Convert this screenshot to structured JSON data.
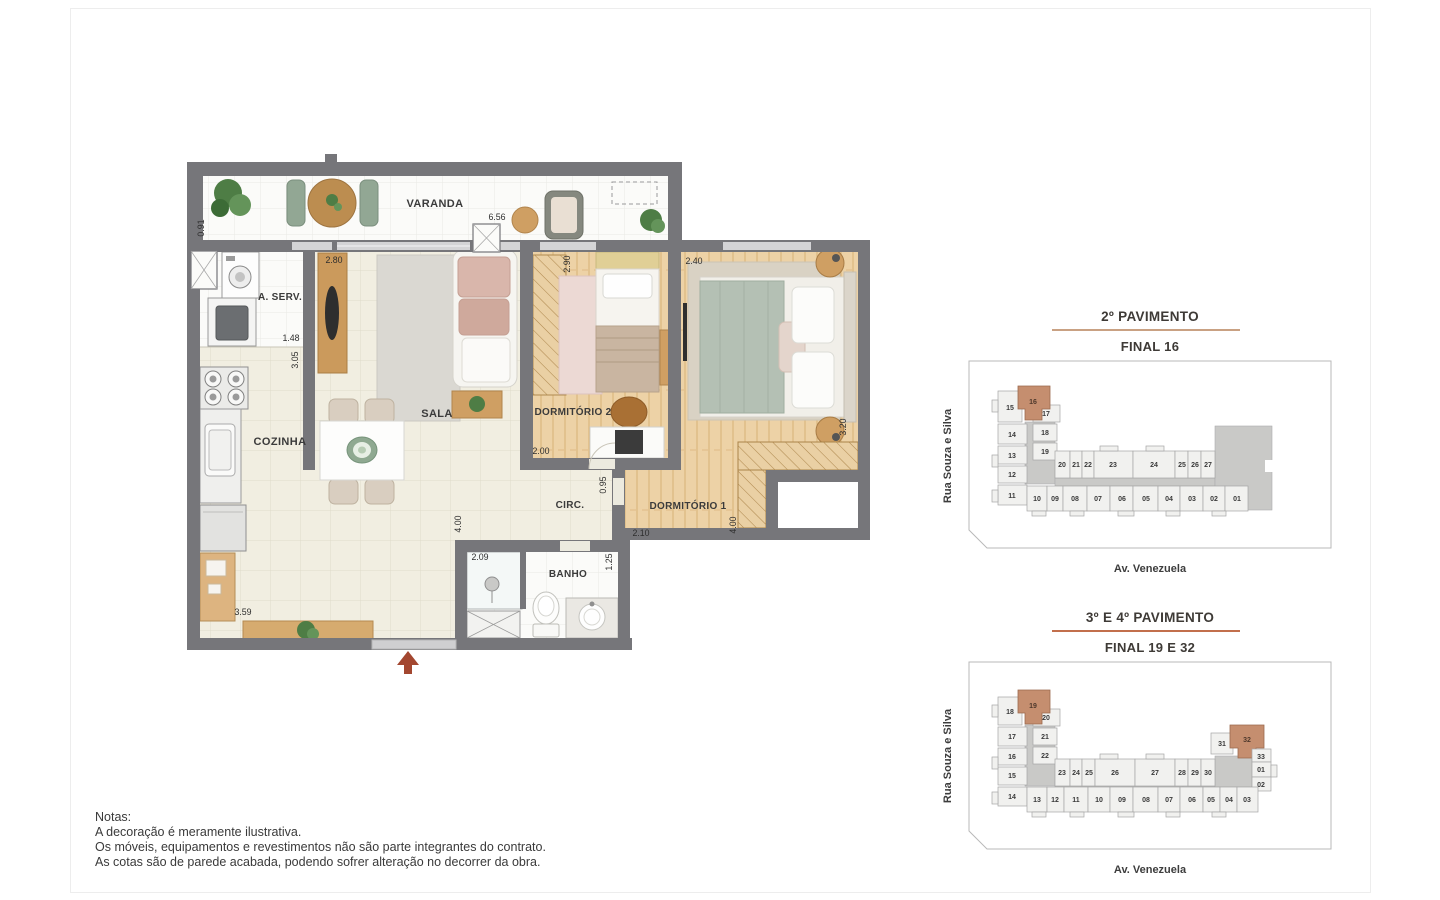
{
  "plan": {
    "rooms": {
      "varanda": "VARANDA",
      "sala": "SALA",
      "cozinha": "COZINHA",
      "aserv": "A. SERV.",
      "dorm1": "DORMITÓRIO 1",
      "dorm2": "DORMITÓRIO 2",
      "banho": "BANHO",
      "circ": "CIRC."
    },
    "dims": {
      "varanda_depth": "0.91",
      "varanda_width": "6.56",
      "sala_width": "2.80",
      "sala_depth": "4.00",
      "aserv_width": "1.48",
      "cozinha_depth": "3.05",
      "cozinha_width": "3.59",
      "dorm2_width": "2.90",
      "dorm2_bottom": "2.00",
      "circ_width": "0.95",
      "dorm1_width": "2.40",
      "dorm1_depth": "3.20",
      "dorm1_bottom": "4.00",
      "dorm1_left": "2.10",
      "banho_width": "2.09",
      "banho_depth": "1.25"
    }
  },
  "keyplans": [
    {
      "title": "2º PAVIMENTO",
      "subtitle": "FINAL 16",
      "street_left": "Rua Souza e Silva",
      "street_bottom": "Av. Venezuela",
      "left_col": [
        "15",
        "14",
        "13",
        "12",
        "11"
      ],
      "cluster": [
        "16",
        "17",
        "18",
        "19"
      ],
      "mid": [
        "20",
        "21",
        "22",
        "23",
        "24",
        "25",
        "26",
        "27"
      ],
      "bottom": [
        "10",
        "09",
        "08",
        "07",
        "06",
        "05",
        "04",
        "03",
        "02",
        "01"
      ]
    },
    {
      "title": "3º E 4º PAVIMENTO",
      "subtitle": "FINAL 19 E 32",
      "street_left": "Rua Souza e Silva",
      "street_bottom": "Av. Venezuela",
      "left_col": [
        "18",
        "17",
        "16",
        "15",
        "14"
      ],
      "cluster": [
        "19",
        "20",
        "21",
        "22"
      ],
      "mid": [
        "23",
        "24",
        "25",
        "26",
        "27",
        "28",
        "29",
        "30"
      ],
      "right": [
        "31",
        "32",
        "33",
        "01",
        "02"
      ],
      "bottom": [
        "13",
        "12",
        "11",
        "10",
        "09",
        "08",
        "07",
        "06",
        "05",
        "04",
        "03"
      ]
    }
  ],
  "notes": {
    "heading": "Notas:",
    "lines": [
      "A decoração é meramente ilustrativa.",
      "Os móveis, equipamentos e revestimentos não são parte integrantes do contrato.",
      "As cotas são de parede acabada, podendo sofrer alteração no decorrer da obra."
    ]
  },
  "colors": {
    "wall": "#76767a",
    "unit_highlight": "#c58e6f",
    "underline_top_panel": "#c9a183",
    "underline_bottom_panel": "#c26f4c",
    "entrance_arrow": "#a34730"
  }
}
